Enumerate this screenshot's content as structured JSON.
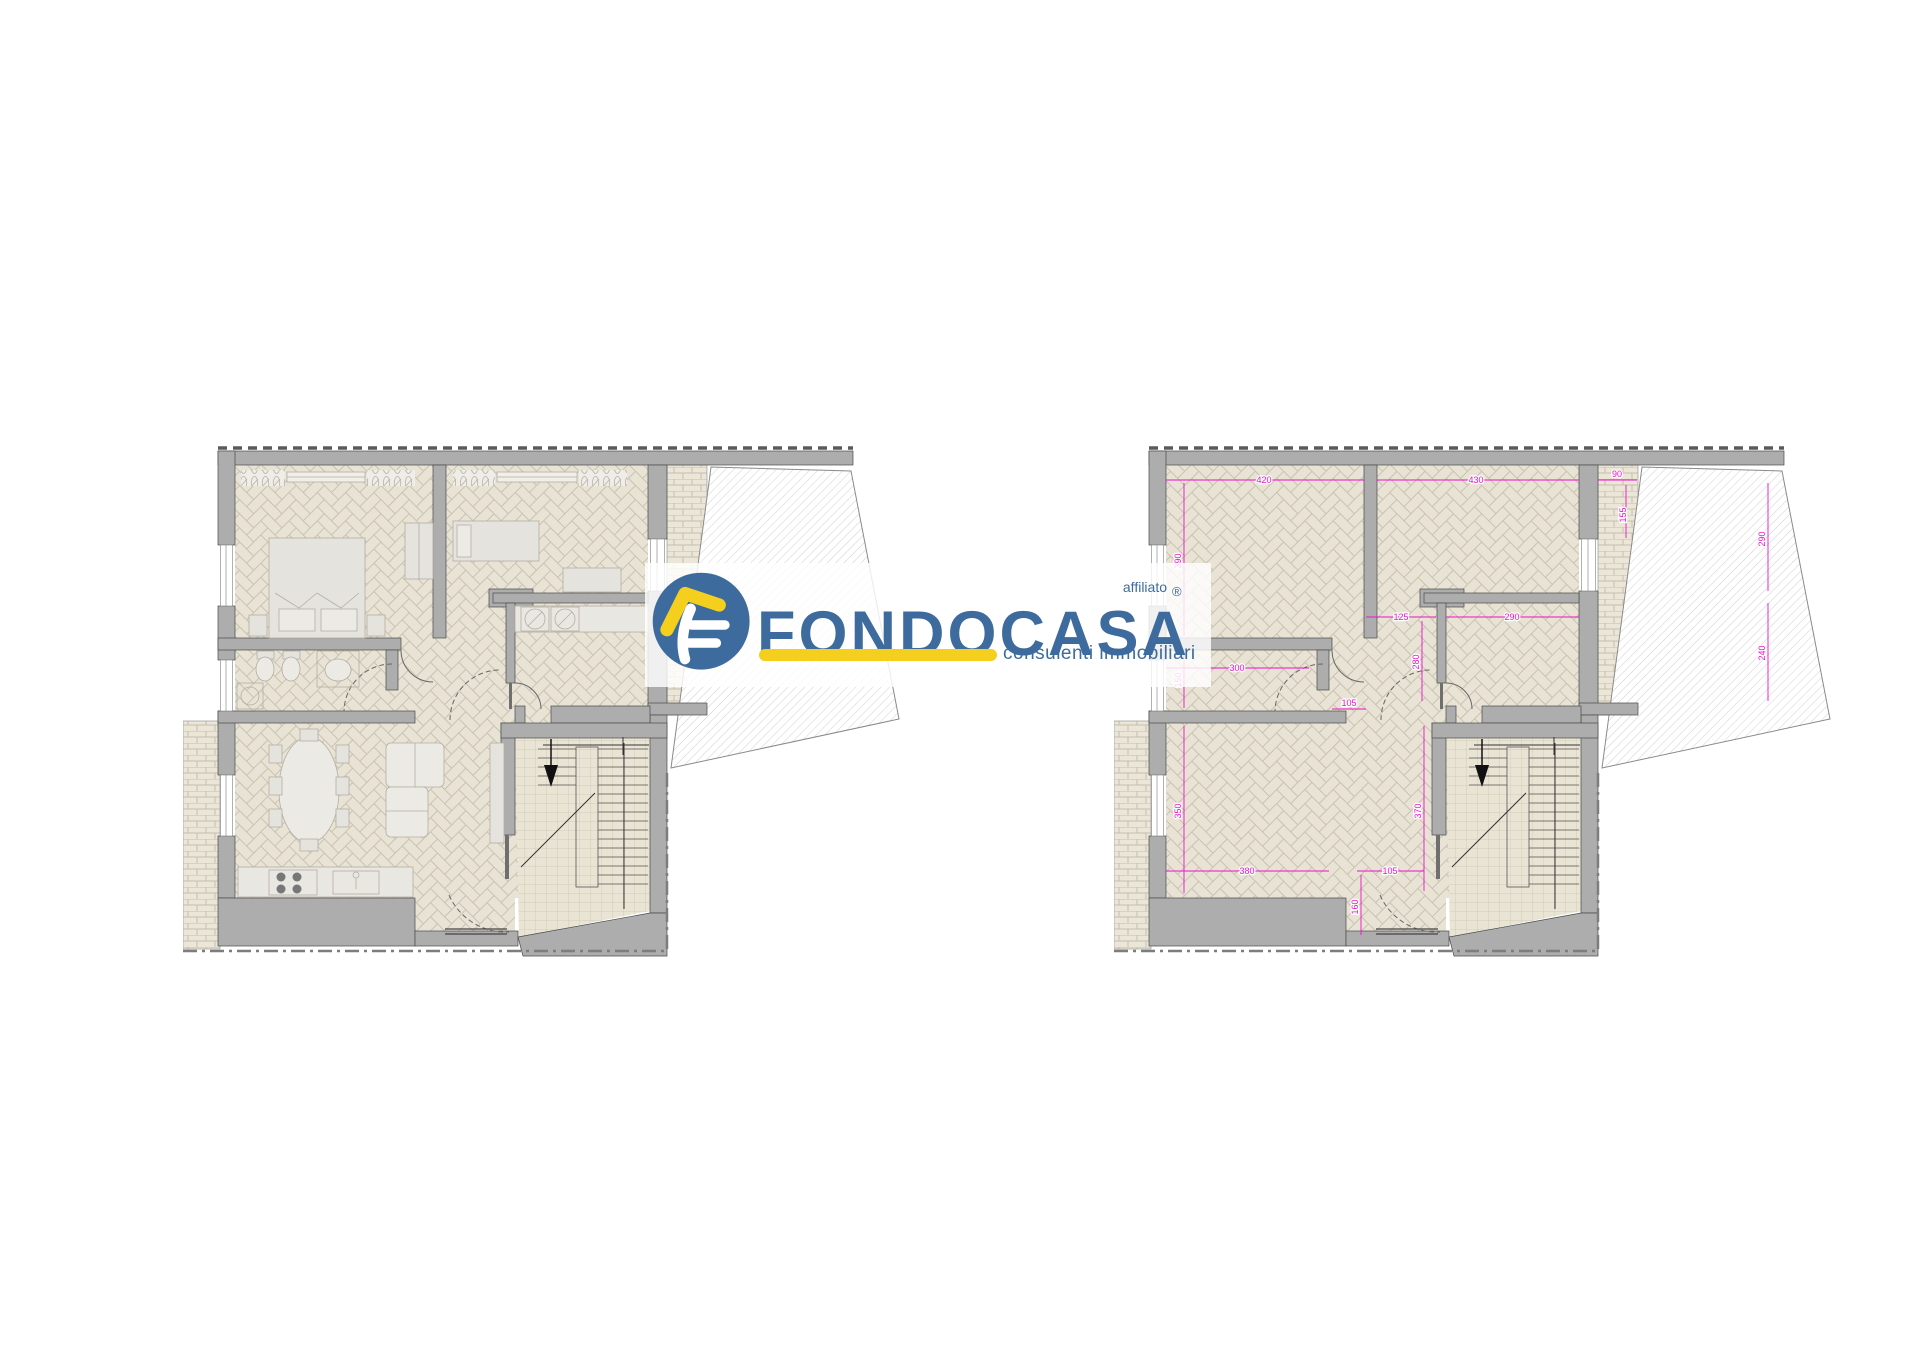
{
  "watermark": {
    "affiliato_label": "affiliato",
    "brand": "FONDOCASA",
    "registered_mark": "®",
    "tagline": "consulenti immobiliari",
    "brand_color": "#3e6b9e",
    "accent_color": "#f4cf1d",
    "badge_icon": "fondocasa-f-roof-icon"
  },
  "plans": {
    "dimension_color": "#ed12cb",
    "stairs_direction_icon": "stairs-down-arrow",
    "dims": {
      "w_bed1": "420",
      "w_bed2": "430",
      "w_balcony": "90",
      "h_balcony": "155",
      "h_bed1": "390",
      "h_bed2": "290",
      "h_room_small": "240",
      "w_bath": "300",
      "w_corridor_door": "105",
      "w_corridor": "125",
      "w_room_small": "290",
      "h_corridor": "280",
      "h_hall_upper": "150",
      "h_living": "350",
      "h_hall": "370",
      "w_living": "380",
      "w_entry": "105",
      "h_entry": "160"
    }
  }
}
